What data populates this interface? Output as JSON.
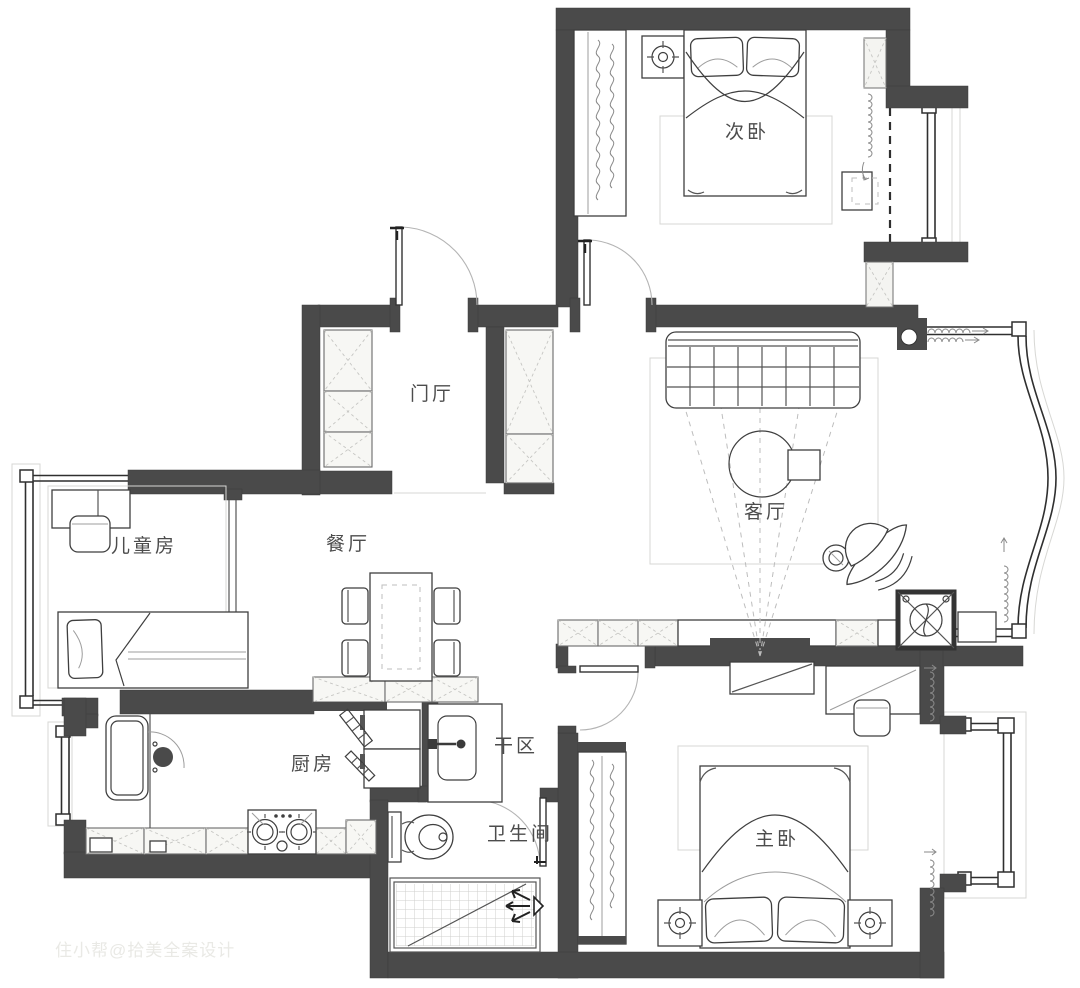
{
  "plan": {
    "type": "residential-floor-plan",
    "language": "zh-CN"
  },
  "colors": {
    "wall": "#4a4a4a",
    "label": "#4c4c4c",
    "furniture-line": "#3f3f3f",
    "hatch": "#f4f4f1",
    "watermark": "#e9e9e5",
    "background": "#ffffff"
  },
  "rooms": {
    "secondary_bedroom": {
      "label": "次卧"
    },
    "entry_hall": {
      "label": "门厅"
    },
    "living_room": {
      "label": "客厅"
    },
    "kids_room": {
      "label": "儿童房"
    },
    "dining_room": {
      "label": "餐厅"
    },
    "kitchen": {
      "label": "厨房"
    },
    "dry_area": {
      "label": "干区"
    },
    "bathroom": {
      "label": "卫生间"
    },
    "master_bedroom": {
      "label": "主卧"
    }
  },
  "watermark": {
    "text": "住小帮@拾美全案设计"
  }
}
